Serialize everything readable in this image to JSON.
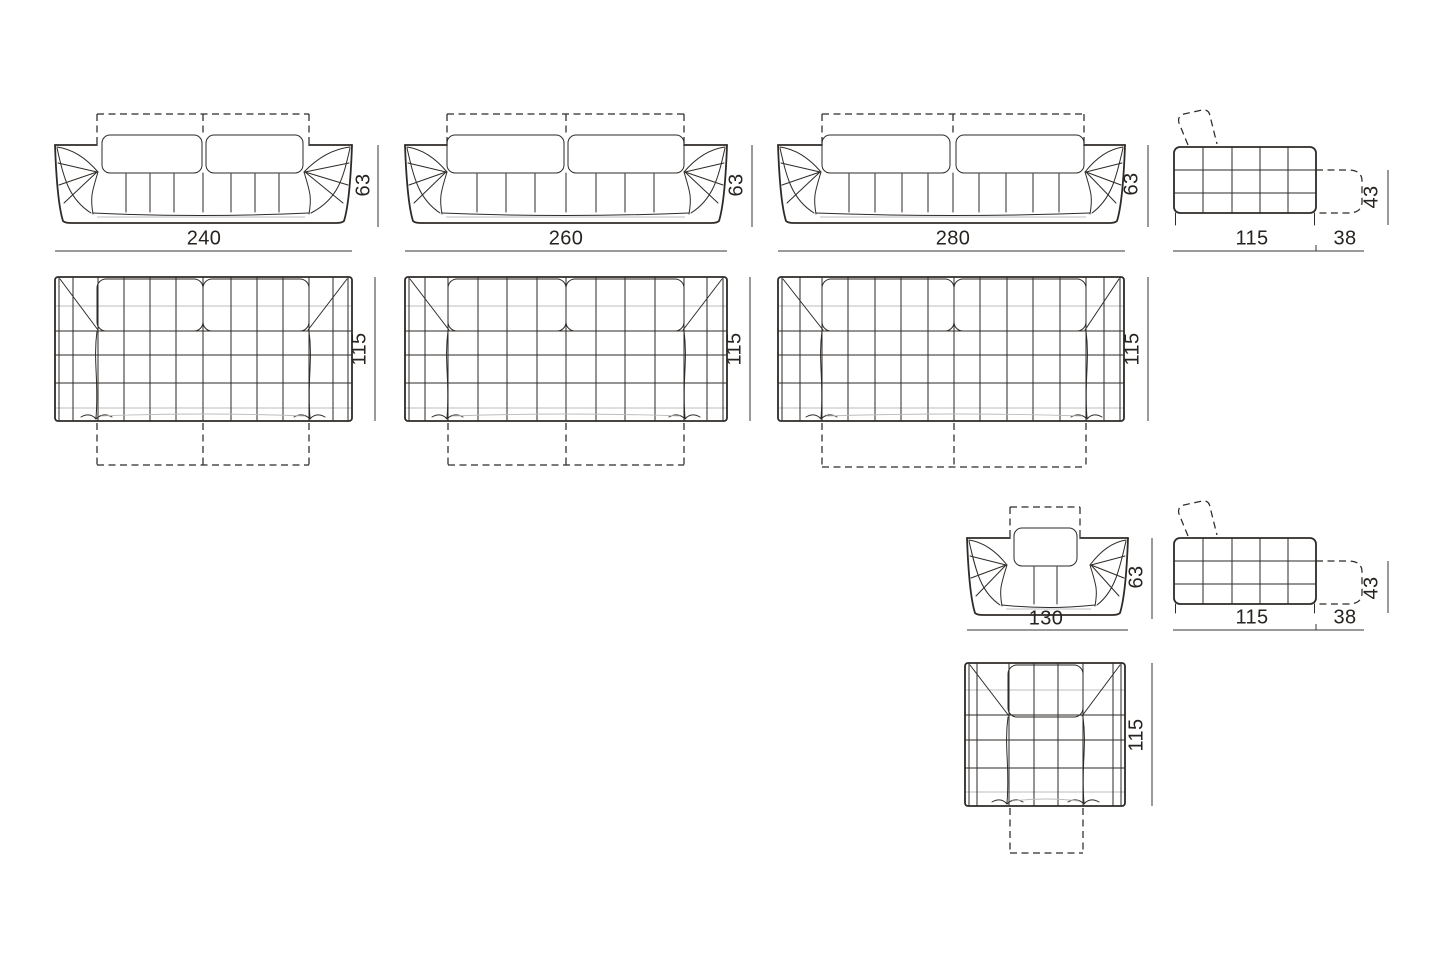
{
  "page": {
    "background_color": "#ffffff",
    "line_color": "#2e2a27",
    "light_line_color": "#bcbcbc",
    "text_color": "#272320"
  },
  "figures": {
    "sofa_240": {
      "front": {
        "width": "240",
        "height": "63"
      },
      "plan": {
        "depth": "115"
      }
    },
    "sofa_260": {
      "front": {
        "width": "260",
        "height": "63"
      },
      "plan": {
        "depth": "115"
      }
    },
    "sofa_280": {
      "front": {
        "width": "280",
        "height": "63"
      },
      "plan": {
        "depth": "115"
      }
    },
    "sofa_side_view": {
      "depth": "115",
      "headrest_extension_depth": "38",
      "extension_height": "43"
    },
    "armchair_130": {
      "front": {
        "width": "130",
        "height": "63"
      },
      "plan": {
        "depth": "115"
      }
    },
    "armchair_side_view": {
      "depth": "115",
      "headrest_extension_depth": "38",
      "extension_height": "43"
    }
  }
}
